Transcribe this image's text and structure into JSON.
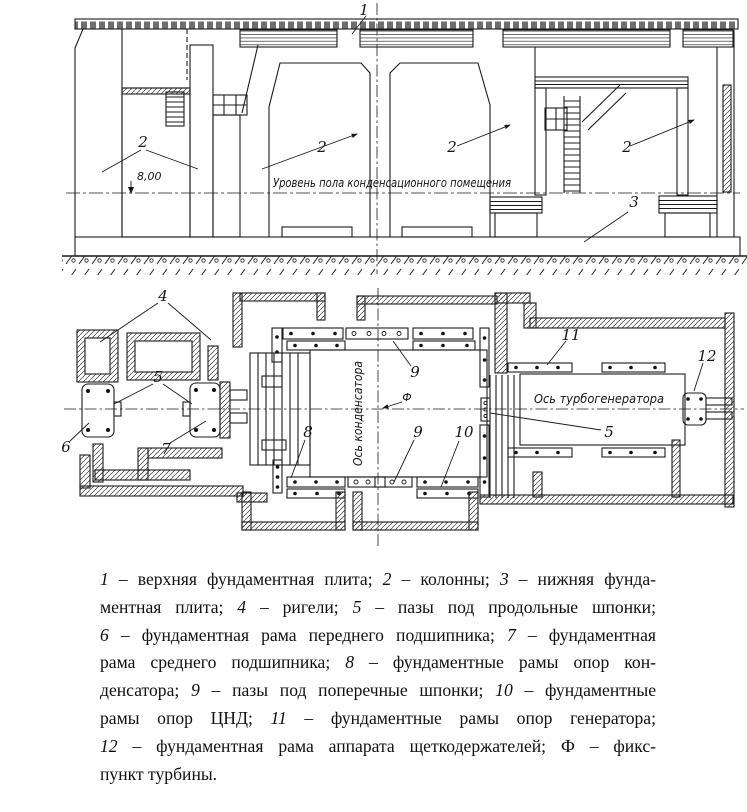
{
  "drawing": {
    "elevation": {
      "label_upper_plate": "1",
      "label_column": "2",
      "label_lower_plate": "3",
      "level_mark": "8,00",
      "floor_level_text": "Уровень пола конденсационного помещения"
    },
    "plan": {
      "label_crossbeams": "4",
      "label_long_keyways": "5",
      "label_front_bearing_frame": "6",
      "label_middle_bearing_frame": "7",
      "label_condenser_frames": "8",
      "label_transverse_keyways": "9",
      "label_lpc_frames": "10",
      "label_generator_frames": "11",
      "label_brush_frame": "12",
      "label_fix_point": "Ф",
      "condenser_axis_text": "Ось конденсатора",
      "turbogenerator_axis_text": "Ось турбогенератора"
    }
  },
  "caption": {
    "lines": [
      [
        {
          "s": "i",
          "t": "1"
        },
        {
          "s": "r",
          "t": " – верхняя фундаментная плита; "
        },
        {
          "s": "i",
          "t": "2"
        },
        {
          "s": "r",
          "t": " – колонны; "
        },
        {
          "s": "i",
          "t": "3"
        },
        {
          "s": "r",
          "t": " – нижняя фунда-"
        }
      ],
      [
        {
          "s": "r",
          "t": "ментная плита; "
        },
        {
          "s": "i",
          "t": "4"
        },
        {
          "s": "r",
          "t": " – ригели; "
        },
        {
          "s": "i",
          "t": "5"
        },
        {
          "s": "r",
          "t": " – пазы под продольные шпонки;"
        }
      ],
      [
        {
          "s": "i",
          "t": "6"
        },
        {
          "s": "r",
          "t": " – фундаментная рама переднего подшипника; "
        },
        {
          "s": "i",
          "t": "7"
        },
        {
          "s": "r",
          "t": " – фундаментная"
        }
      ],
      [
        {
          "s": "r",
          "t": "рама среднего подшипника; "
        },
        {
          "s": "i",
          "t": "8"
        },
        {
          "s": "r",
          "t": " – фундаментные рамы опор кон-"
        }
      ],
      [
        {
          "s": "r",
          "t": "денсатора; "
        },
        {
          "s": "i",
          "t": "9"
        },
        {
          "s": "r",
          "t": " – пазы под поперечные шпонки; "
        },
        {
          "s": "i",
          "t": "10"
        },
        {
          "s": "r",
          "t": " – фундаментные"
        }
      ],
      [
        {
          "s": "r",
          "t": "рамы опор ЦНД; "
        },
        {
          "s": "i",
          "t": "11"
        },
        {
          "s": "r",
          "t": " – фундаментные рамы опор генератора;"
        }
      ],
      [
        {
          "s": "i",
          "t": "12"
        },
        {
          "s": "r",
          "t": " – фундаментная рама аппарата щеткодержателей; Ф – фикс-"
        }
      ],
      [
        {
          "s": "r",
          "t": "пункт турбины."
        }
      ]
    ]
  }
}
